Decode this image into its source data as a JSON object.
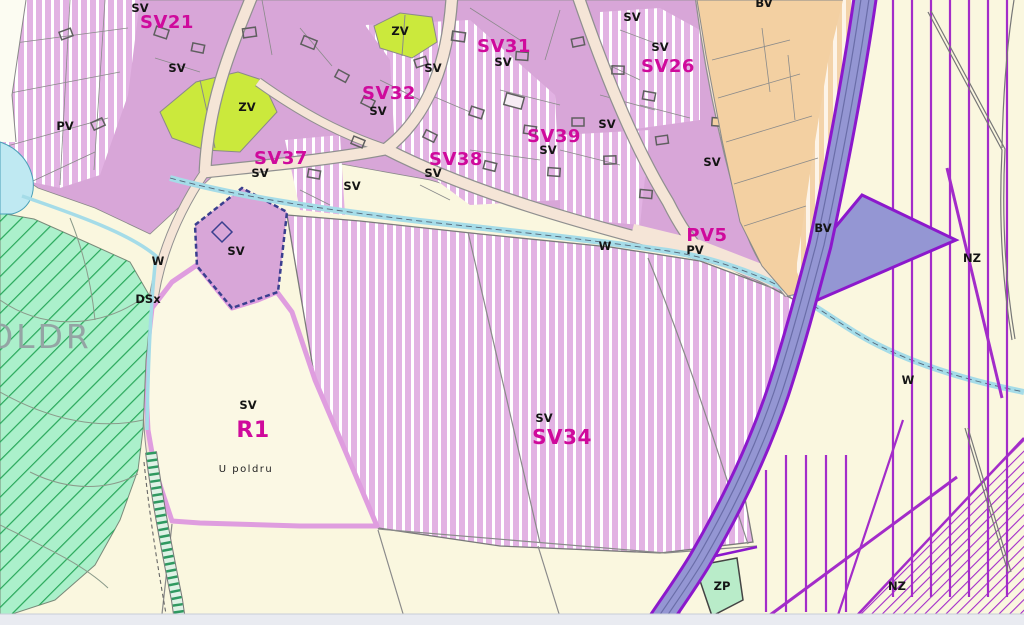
{
  "map": {
    "zone_fills": {
      "SV_mixed_residential_violet": "#d8a6d8",
      "SV_striped_violet": "#e2b2e3",
      "BV_tan": "#f3d0a2",
      "ZV_yellow_green": "#cbe93c",
      "ZP_light_green": "#b9ecc9",
      "poldr_green": "#abf0cb",
      "green_hatch_line": "#28a85a",
      "background_cream": "#faf7df",
      "road_fill": "#f5e5d7",
      "water_blue": "#a5dce8",
      "pond_blue": "#bfe9f2",
      "highway_fill": "#9496d3",
      "highway_edge_purple": "#8c18cc",
      "nz_hatch_purple": "#a32cc9",
      "r1_border_pink": "#df9ddf",
      "dashed_plan_border": "#3a3f8f",
      "label_magenta": "#cf0a9c",
      "label_black": "#141414",
      "poldr_text_gray": "#94a4a4"
    },
    "zone_labels": [
      {
        "text": "SV21",
        "x": 167,
        "y": 28
      },
      {
        "text": "SV31",
        "x": 504,
        "y": 52
      },
      {
        "text": "SV32",
        "x": 389,
        "y": 99
      },
      {
        "text": "SV26",
        "x": 668,
        "y": 72
      },
      {
        "text": "SV39",
        "x": 554,
        "y": 142
      },
      {
        "text": "SV38",
        "x": 456,
        "y": 165
      },
      {
        "text": "SV37",
        "x": 281,
        "y": 164
      },
      {
        "text": "PV5",
        "x": 707,
        "y": 241
      },
      {
        "text": "SV34",
        "x": 562,
        "y": 444,
        "size": 20
      },
      {
        "text": "R1",
        "x": 253,
        "y": 437,
        "size": 22
      }
    ],
    "code_labels": [
      {
        "text": "SV",
        "x": 140,
        "y": 12
      },
      {
        "text": "SV",
        "x": 177,
        "y": 72
      },
      {
        "text": "SV",
        "x": 632,
        "y": 21
      },
      {
        "text": "SV",
        "x": 660,
        "y": 51
      },
      {
        "text": "SV",
        "x": 503,
        "y": 66
      },
      {
        "text": "SV",
        "x": 433,
        "y": 72
      },
      {
        "text": "SV",
        "x": 378,
        "y": 115
      },
      {
        "text": "SV",
        "x": 607,
        "y": 128
      },
      {
        "text": "SV",
        "x": 548,
        "y": 154
      },
      {
        "text": "SV",
        "x": 433,
        "y": 177
      },
      {
        "text": "SV",
        "x": 352,
        "y": 190
      },
      {
        "text": "SV",
        "x": 260,
        "y": 177
      },
      {
        "text": "SV",
        "x": 712,
        "y": 166
      },
      {
        "text": "SV",
        "x": 236,
        "y": 255
      },
      {
        "text": "SV",
        "x": 544,
        "y": 422
      },
      {
        "text": "SV",
        "x": 248,
        "y": 409
      },
      {
        "text": "ZV",
        "x": 247,
        "y": 111
      },
      {
        "text": "ZV",
        "x": 400,
        "y": 35
      },
      {
        "text": "PV",
        "x": 65,
        "y": 130
      },
      {
        "text": "PV",
        "x": 695,
        "y": 254
      },
      {
        "text": "BV",
        "x": 764,
        "y": 7
      },
      {
        "text": "BV",
        "x": 823,
        "y": 232
      },
      {
        "text": "W",
        "x": 158,
        "y": 265
      },
      {
        "text": "W",
        "x": 605,
        "y": 250
      },
      {
        "text": "W",
        "x": 908,
        "y": 384
      },
      {
        "text": "NZ",
        "x": 972,
        "y": 262
      },
      {
        "text": "NZ",
        "x": 897,
        "y": 590
      },
      {
        "text": "DSx",
        "x": 148,
        "y": 303
      },
      {
        "text": "ZP",
        "x": 722,
        "y": 590
      }
    ],
    "area_labels": [
      {
        "text": "POLDR",
        "x": 28,
        "y": 348,
        "size": 33,
        "color": "#94a4a4",
        "spacing": 3,
        "weight": "normal"
      },
      {
        "text": "U poldru",
        "x": 246,
        "y": 472,
        "size": 10,
        "color": "#222222",
        "spacing": 1.5,
        "weight": "normal"
      }
    ]
  }
}
